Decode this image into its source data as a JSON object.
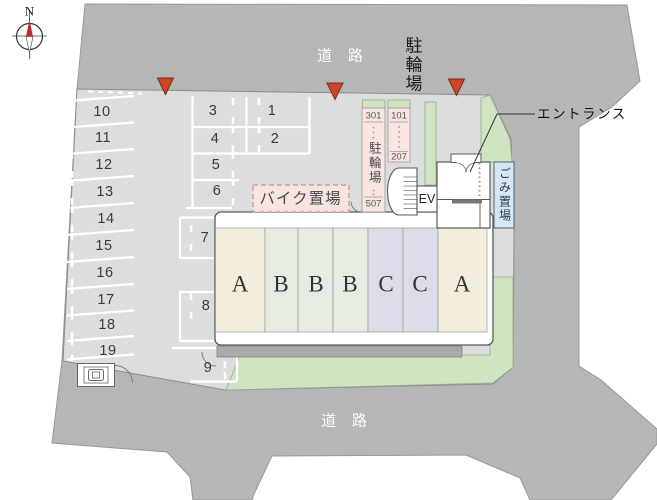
{
  "compass": {
    "north": "N"
  },
  "roads": {
    "top": "道 路",
    "bottom": "道 路"
  },
  "facilities": {
    "bicycle_road": "駐輪場",
    "bike_storage": "バイク置場",
    "entrance": "エントランス",
    "garbage": "ごみ置場",
    "elevator": "EV",
    "bike_left": {
      "top": "301",
      "name": "駐輪場",
      "bottom": "507"
    },
    "bike_right": {
      "top": "101",
      "bottom": "207"
    }
  },
  "units": [
    "A",
    "B",
    "B",
    "B",
    "C",
    "C",
    "A"
  ],
  "parking": {
    "stalls": [
      "1",
      "2",
      "3",
      "4",
      "5",
      "6",
      "7",
      "8",
      "9",
      "10",
      "11",
      "12",
      "13",
      "14",
      "15",
      "16",
      "17",
      "18",
      "19"
    ]
  },
  "colors": {
    "road": "#b5b6b6",
    "site": "#dcdddd",
    "green": "#cfe5c2",
    "unit_a": "#f1ecdb",
    "unit_b": "#e7ece3",
    "unit_c": "#dcdde9",
    "bike_pink": "#f8e4e1",
    "garbage_blue": "#d5e7f2",
    "marker_red": "#cd4727",
    "eave": "#a9abab"
  }
}
